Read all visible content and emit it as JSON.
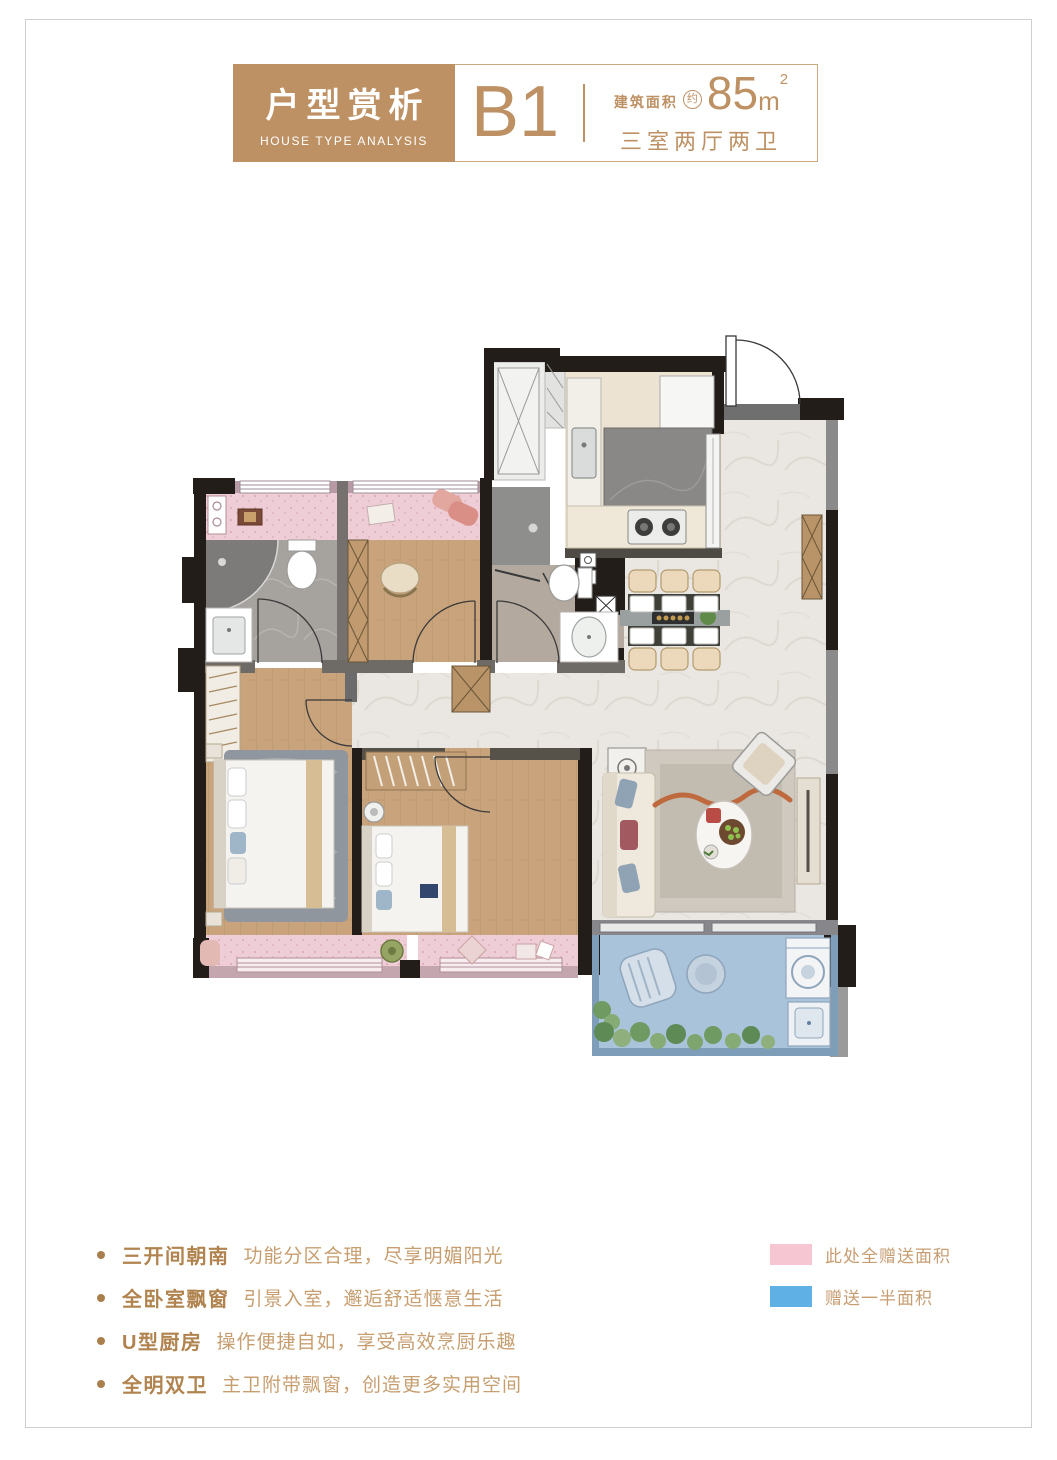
{
  "header": {
    "title_cn": "户型赏析",
    "title_en": "HOUSE TYPE ANALYSIS",
    "unit": "B1",
    "area_label": "建筑面积",
    "area_approx": "约",
    "area_value": "85",
    "area_unit": "m",
    "area_sup": "2",
    "rooms": "三室两厅两卫"
  },
  "features": [
    {
      "title": "三开间朝南",
      "desc": "功能分区合理，尽享明媚阳光"
    },
    {
      "title": "全卧室飘窗",
      "desc": "引景入室，邂逅舒适惬意生活"
    },
    {
      "title": "U型厨房",
      "desc": "操作便捷自如，享受高效烹厨乐趣"
    },
    {
      "title": "全明双卫",
      "desc": "主卫附带飘窗，创造更多实用空间"
    }
  ],
  "legend": [
    {
      "label": "此处全赠送面积",
      "color": "#f6c6d2"
    },
    {
      "label": "赠送一半面积",
      "color": "#5fb0e5"
    }
  ],
  "colors": {
    "gold": "#bd9164",
    "wall": "#221d19",
    "gift_pink": "#eecdd6",
    "half_gift_blue": "#a9c3da",
    "wood_floor": "#c9a37b",
    "marble_floor": "#eae7e2"
  }
}
